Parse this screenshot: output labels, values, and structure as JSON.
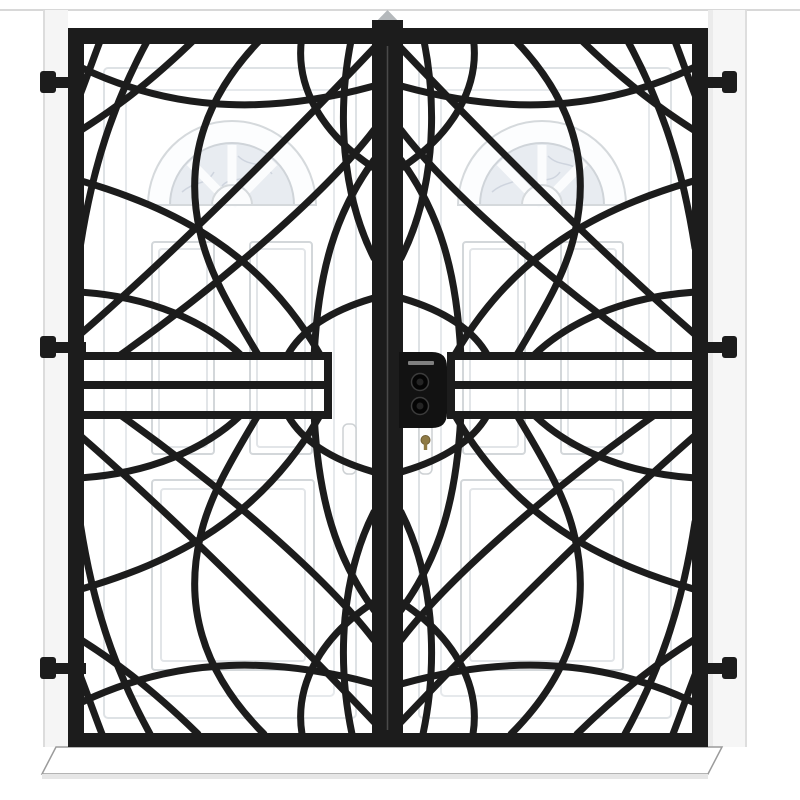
{
  "photo": {
    "subject_label": "Black wrought-iron double-door security grille with decorative intersecting arc pattern mounted over white entry doors",
    "colors": {
      "grille_black": "#1c1c1c",
      "lock_black": "#121212",
      "door_white": "#ffffff",
      "molding_gray": "#d7dbde",
      "inner_molding_gray": "#e4e7ea",
      "glass_gray": "#e8ecf1",
      "wall_line_gray": "#d8d8d8",
      "sill_outline_gray": "#9b9b9b",
      "post_cap_gray": "#b4b8bb",
      "keyhole_gold": "#8f7a45"
    },
    "parts": {
      "frame": {
        "label": "outer grille frame"
      },
      "left_leaf": {
        "label": "left grille leaf with curved ironwork"
      },
      "right_leaf": {
        "label": "right grille leaf with curved ironwork"
      },
      "center_post": {
        "label": "central meeting stiles of the two leaves"
      },
      "lock": {
        "label": "grille lock box with two cylinder knobs"
      },
      "band": {
        "label": "middle horizontal reinforcement band of three rails"
      },
      "hinges": {
        "label": "wall mounting hinge brackets",
        "count": 6
      },
      "left_door": {
        "label": "white entry door behind left leaf"
      },
      "right_door": {
        "label": "white entry door behind right leaf"
      },
      "fanlight_left": {
        "label": "arched fanlight window of left door"
      },
      "fanlight_right": {
        "label": "arched fanlight window of right door"
      },
      "door_handles": {
        "label": "door escutcheon plates and gold keyhole"
      },
      "sill": {
        "label": "white threshold sill below the grille"
      },
      "wall": {
        "label": "white wall reveal around the grille"
      }
    }
  }
}
